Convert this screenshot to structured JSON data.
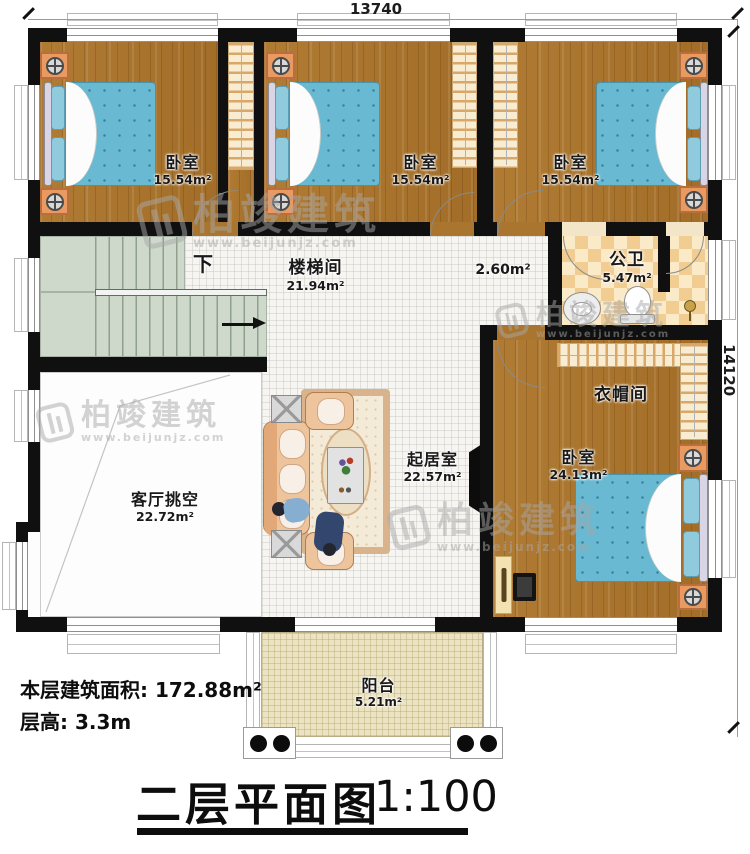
{
  "floorplan": {
    "title": "二层平面图",
    "scale": "1:100",
    "stats": {
      "floor_area": "本层建筑面积: 172.88m²",
      "floor_height": "层高: 3.3m"
    },
    "dimensions": {
      "width_mm": "13740",
      "depth_mm": "14120"
    },
    "rooms": {
      "bedroom_top_left": {
        "name": "卧室",
        "area": "15.54m²"
      },
      "bedroom_top_middle": {
        "name": "卧室",
        "area": "15.54m²"
      },
      "bedroom_top_right": {
        "name": "卧室",
        "area": "15.54m²"
      },
      "stairwell": {
        "name": "楼梯间",
        "area": "21.94m²",
        "direction_label": "下"
      },
      "hallway": {
        "area": "2.60m²"
      },
      "public_bathroom": {
        "name": "公卫",
        "area": "5.47m²"
      },
      "cloakroom": {
        "name": "衣帽间"
      },
      "master_bedroom": {
        "name": "卧室",
        "area": "24.13m²"
      },
      "living_room": {
        "name": "起居室",
        "area": "22.57m²"
      },
      "living_room_void": {
        "name": "客厅挑空",
        "area": "22.72m²"
      },
      "balcony": {
        "name": "阳台",
        "area": "5.21m²"
      }
    },
    "watermark": {
      "brand": "柏竣建筑",
      "website": "www.beijunjz.com"
    },
    "colors": {
      "wall": "#101010",
      "wood_floor": "#a9752f",
      "mattress_blue": "#68b9d1",
      "checker_tan": "#f2cd92",
      "stair_green": "#cfd9cb",
      "balcony_cream": "#ebe3c2",
      "nightstand_orange": "#e89a61"
    }
  }
}
